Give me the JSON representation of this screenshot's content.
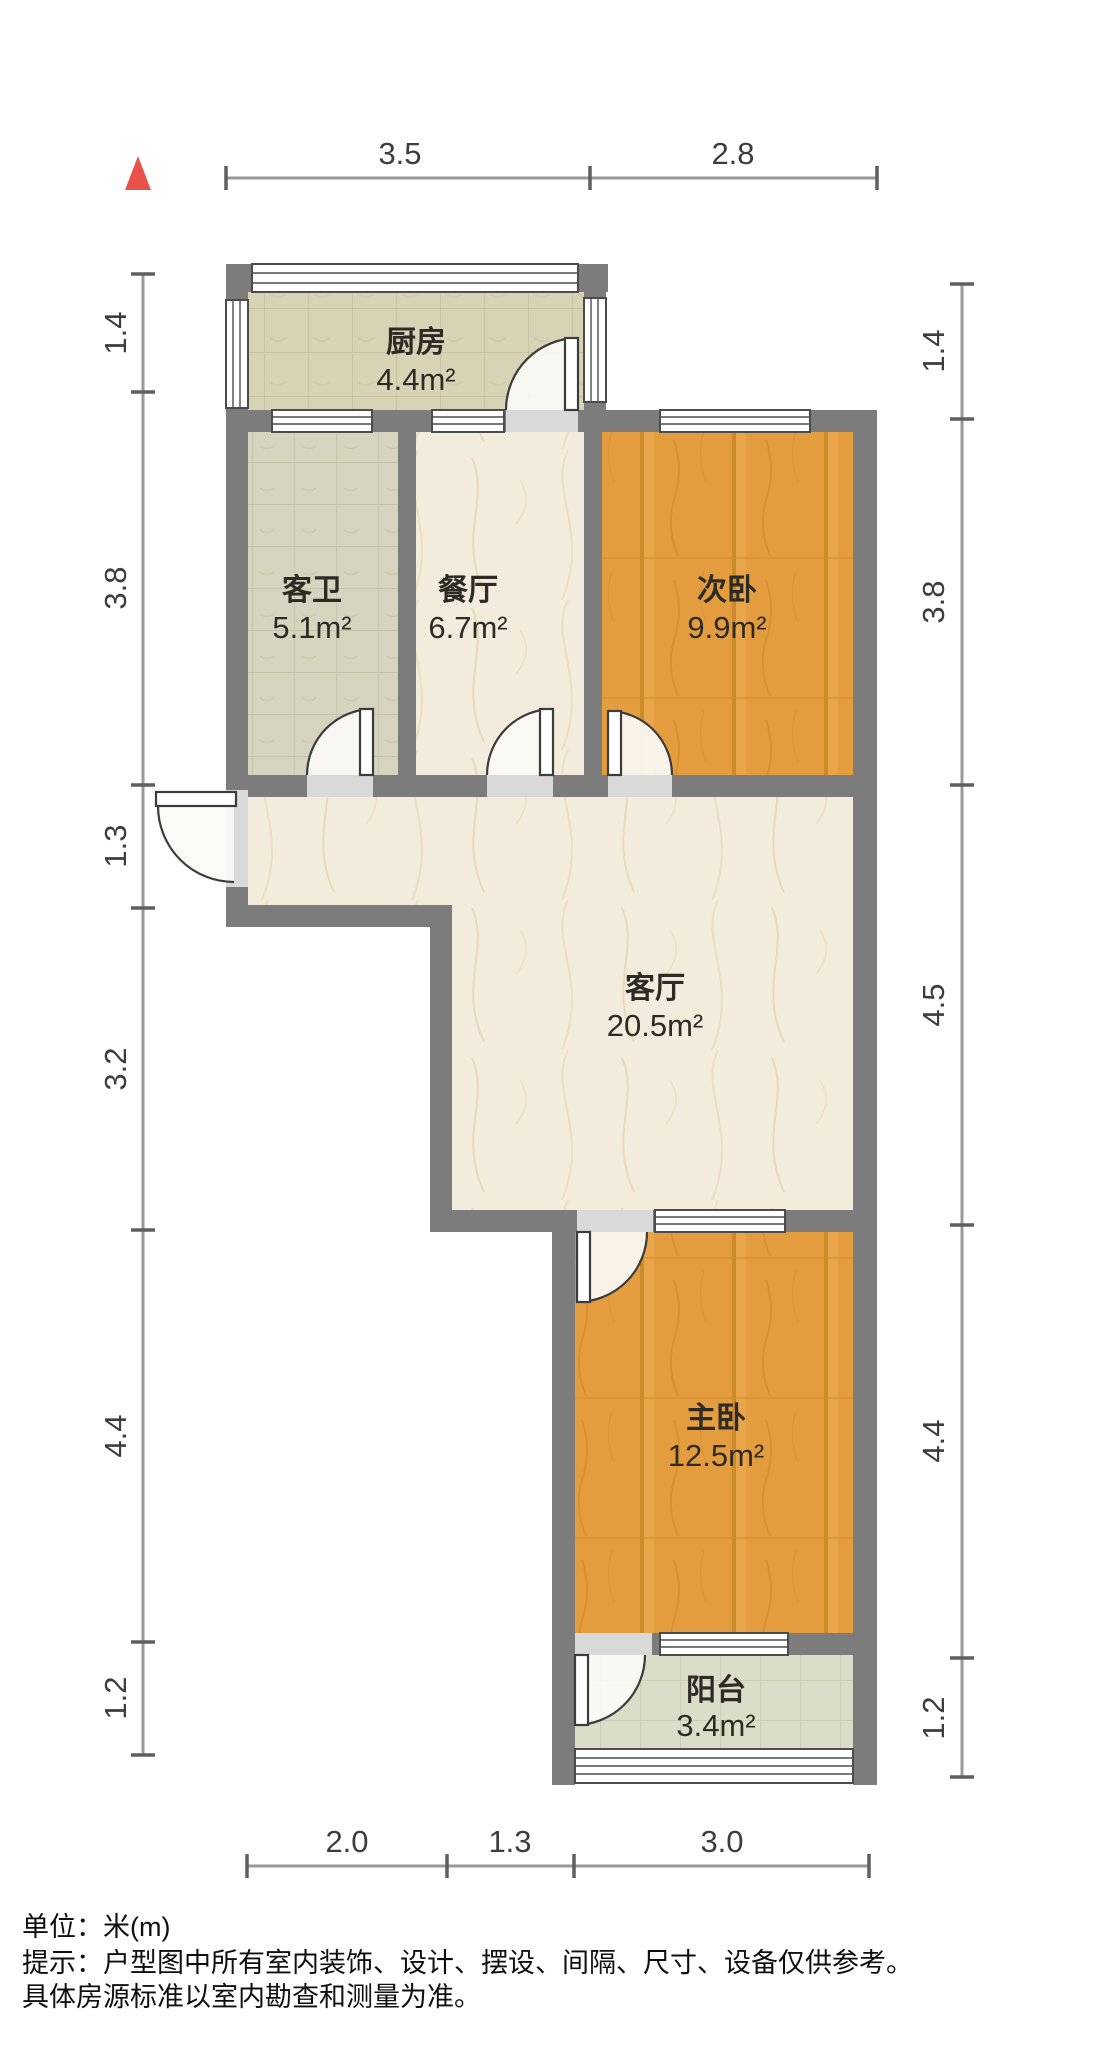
{
  "plan": {
    "type": "apartment-floor-plan",
    "north_symbol": "▲",
    "colors": {
      "wall": "#7c7c7c",
      "north_arrow": "#e8524a",
      "wood_floor": "#e49d3e",
      "marble_floor": "#f3ebdb",
      "kitchen_tile": "#d9d3b6",
      "bath_tile": "#d6d4be",
      "balcony_tile": "#dcddc8",
      "label_text": "#2e2b26",
      "dim_text": "#3d3d3d"
    }
  },
  "rooms": {
    "kitchen": {
      "name": "厨房",
      "area": "4.4m²"
    },
    "bath": {
      "name": "客卫",
      "area": "5.1m²"
    },
    "dining": {
      "name": "餐厅",
      "area": "6.7m²"
    },
    "bedroom2": {
      "name": "次卧",
      "area": "9.9m²"
    },
    "living": {
      "name": "客厅",
      "area": "20.5m²"
    },
    "master": {
      "name": "主卧",
      "area": "12.5m²"
    },
    "balcony": {
      "name": "阳台",
      "area": "3.4m²"
    }
  },
  "dimensions": {
    "top": [
      "3.5",
      "2.8"
    ],
    "left": [
      "1.4",
      "3.8",
      "1.3",
      "3.2",
      "4.4",
      "1.2"
    ],
    "right": [
      "1.4",
      "3.8",
      "4.5",
      "4.4",
      "1.2"
    ],
    "bottom": [
      "2.0",
      "1.3",
      "3.0"
    ]
  },
  "notes": {
    "unit": "单位：米(m)",
    "tip1": "提示：户型图中所有室内装饰、设计、摆设、间隔、尺寸、设备仅供参考。",
    "tip2": "具体房源标准以室内勘查和测量为准。"
  }
}
